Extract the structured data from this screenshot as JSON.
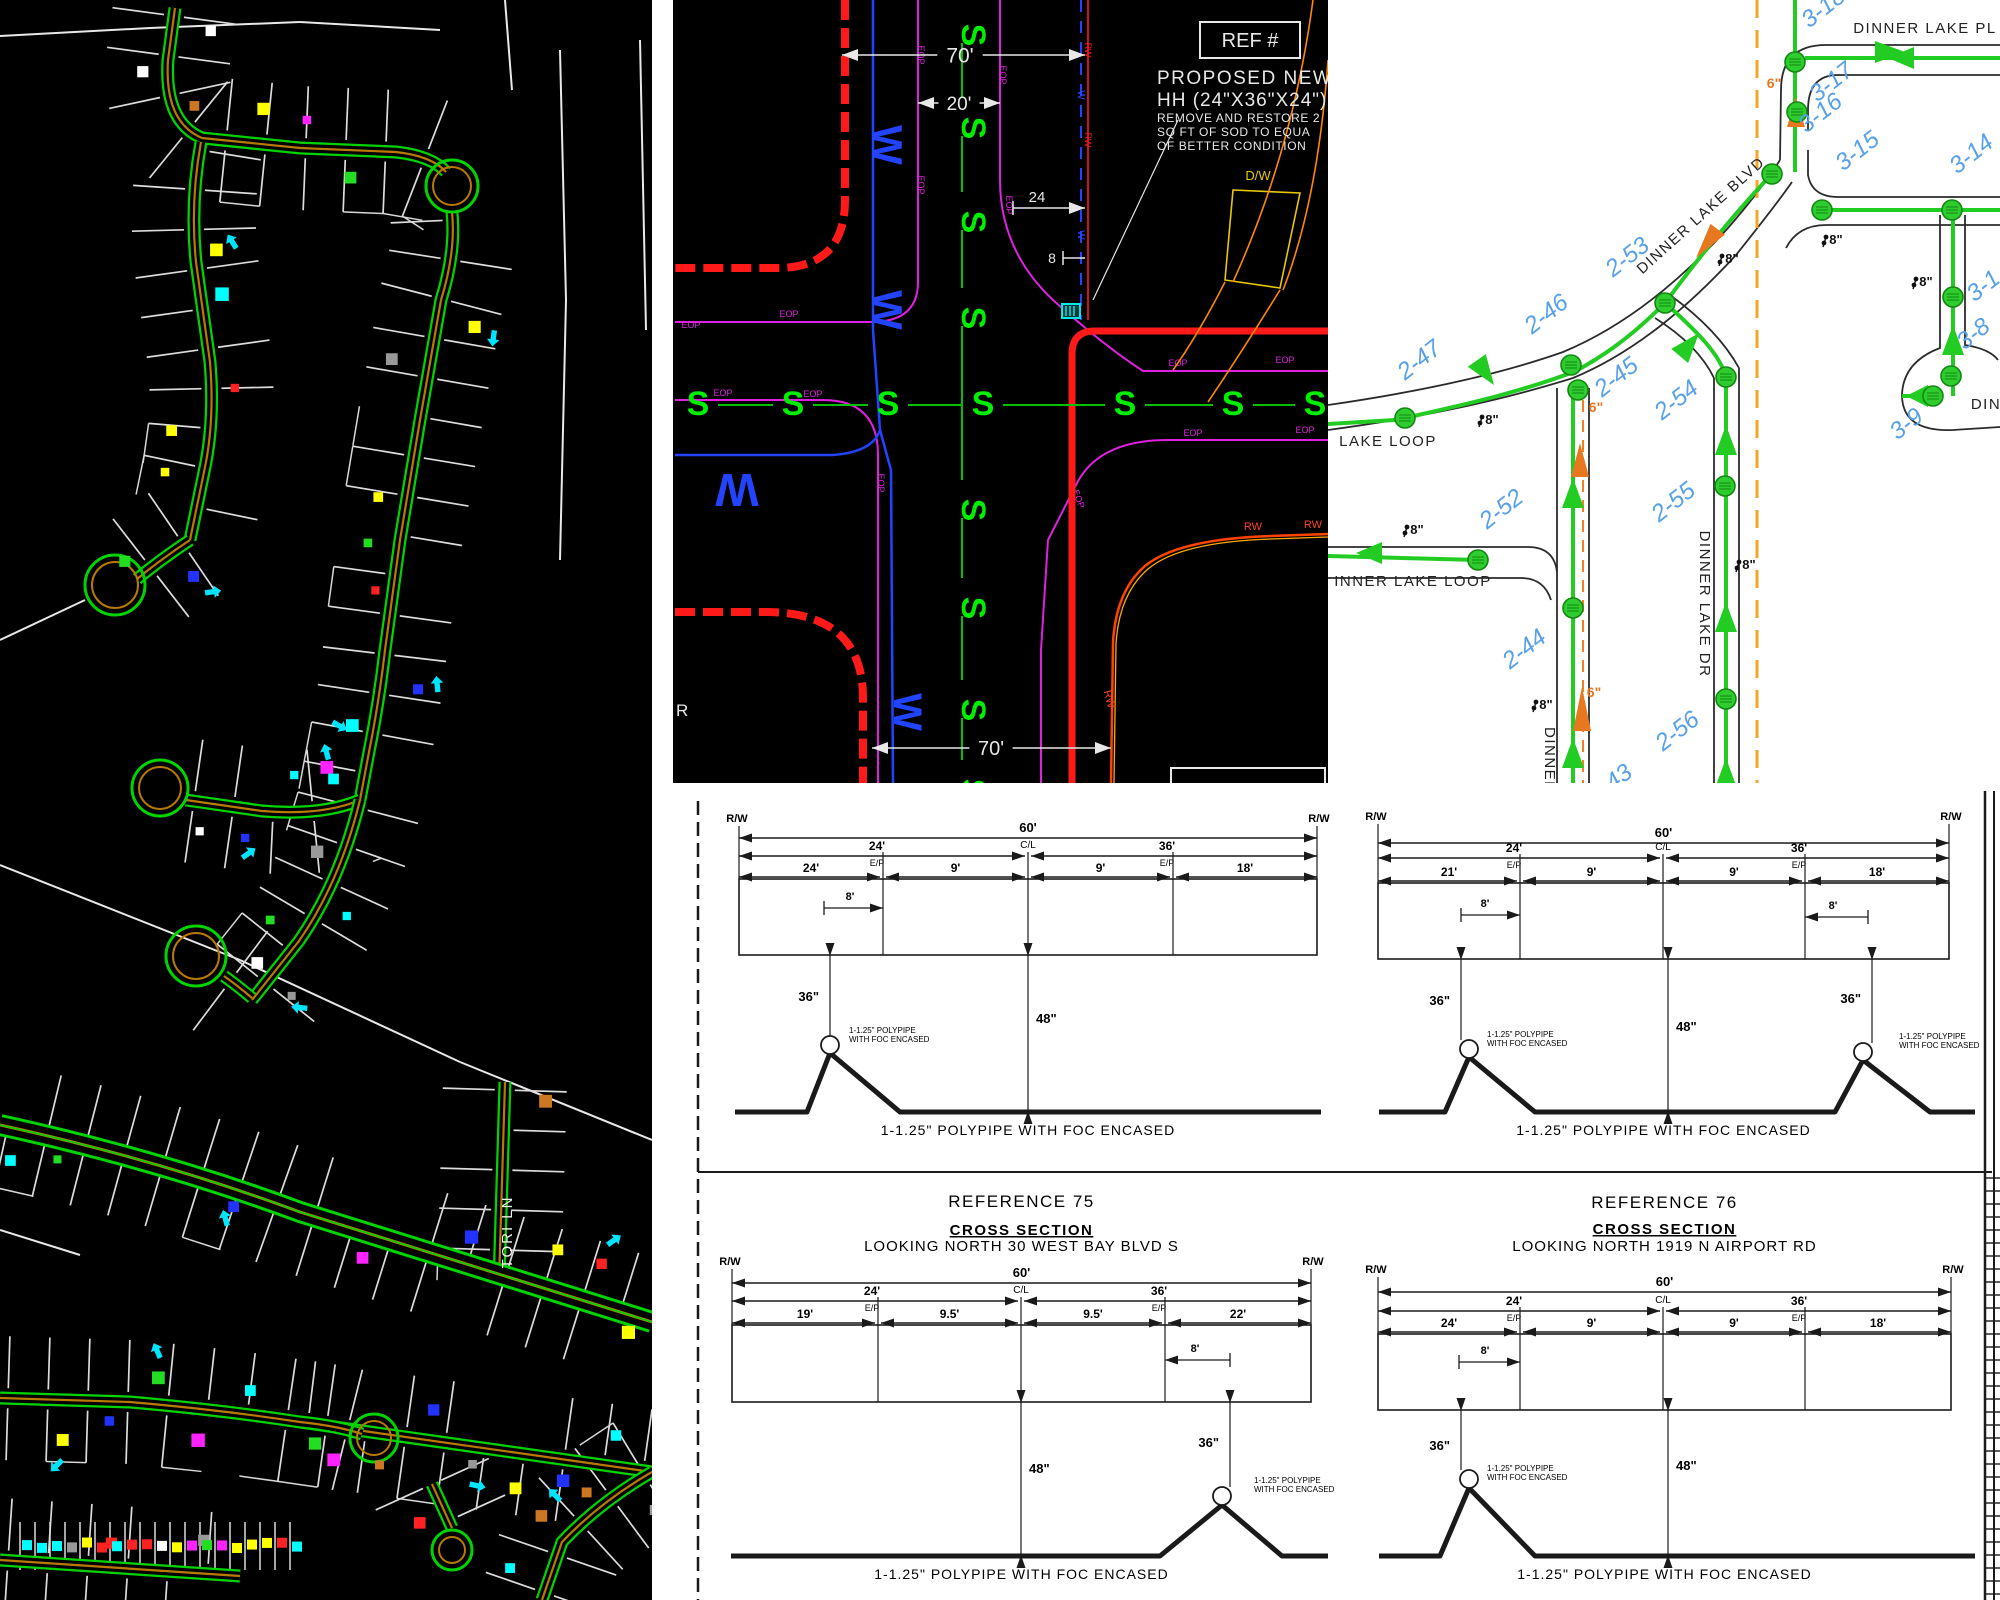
{
  "left_map": {
    "street_label": "TORI LN",
    "marker_colors": [
      "#ffff00",
      "#ff2222",
      "#ff22ff",
      "#00ffff",
      "#2233ff",
      "#22dd22",
      "#ffffff",
      "#999999",
      "#cc7722"
    ]
  },
  "intersection": {
    "ref_label": "REF #",
    "callout_lines": [
      "PROPOSED NEW F",
      "HH (24\"X36\"X24\")",
      "REMOVE AND RESTORE 2",
      "SQ FT OF SOD TO EQUA",
      "OF BETTER CONDITION"
    ],
    "dw_label": "D/W",
    "eop_label": "EOP",
    "rw_label": "RW",
    "sewer_glyph": "S",
    "water_glyph": "W",
    "street_partial": "R",
    "dims": {
      "top_width": "70'",
      "pavement": "20'",
      "offset": "24",
      "hh_offset": "8",
      "bottom_width": "70'"
    }
  },
  "route_map": {
    "streets": [
      {
        "text": "DINNER LAKE PL",
        "x": 597,
        "y": 33,
        "rot": 0
      },
      {
        "text": "DINNER LAKE BLVD",
        "x": 376,
        "y": 219,
        "rot": -42
      },
      {
        "text": "DINNER LAKE DR",
        "x": 372,
        "y": 604,
        "rot": 90
      },
      {
        "text": "LAKE LOOP",
        "x": 60,
        "y": 446,
        "rot": 0
      },
      {
        "text": "INNER LAKE LOOP",
        "x": 85,
        "y": 586,
        "rot": 0
      },
      {
        "text": "DINNER L",
        "x": 217,
        "y": 768,
        "rot": 90
      },
      {
        "text": "DIN",
        "x": 658,
        "y": 409,
        "rot": 0
      }
    ],
    "handholes": [
      {
        "text": "2-47",
        "x": 96,
        "y": 366
      },
      {
        "text": "2-46",
        "x": 223,
        "y": 320
      },
      {
        "text": "2-53",
        "x": 304,
        "y": 263
      },
      {
        "text": "2-45",
        "x": 293,
        "y": 383
      },
      {
        "text": "2-54",
        "x": 353,
        "y": 406
      },
      {
        "text": "2-52",
        "x": 178,
        "y": 515
      },
      {
        "text": "2-55",
        "x": 350,
        "y": 508
      },
      {
        "text": "2-44",
        "x": 201,
        "y": 655
      },
      {
        "text": "2-56",
        "x": 354,
        "y": 737
      },
      {
        "text": "2-43",
        "x": 287,
        "y": 790
      },
      {
        "text": "3-17",
        "x": 508,
        "y": 88
      },
      {
        "text": "3-16",
        "x": 497,
        "y": 119
      },
      {
        "text": "3-18",
        "x": 500,
        "y": 14
      },
      {
        "text": "3-15",
        "x": 534,
        "y": 157
      },
      {
        "text": "3-14",
        "x": 648,
        "y": 160
      },
      {
        "text": "3-1",
        "x": 660,
        "y": 292
      },
      {
        "text": "3-9",
        "x": 583,
        "y": 430
      },
      {
        "text": "3-8",
        "x": 650,
        "y": 340
      }
    ],
    "six_labels": [
      {
        "x": 446,
        "y": 88
      },
      {
        "x": 268,
        "y": 412
      },
      {
        "x": 266,
        "y": 697
      }
    ],
    "six_text": "6\"",
    "eight_labels": [
      {
        "x": 404,
        "y": 263
      },
      {
        "x": 598,
        "y": 286
      },
      {
        "x": 164,
        "y": 424
      },
      {
        "x": 89,
        "y": 534
      },
      {
        "x": 218,
        "y": 709
      },
      {
        "x": 421,
        "y": 569
      },
      {
        "x": 508,
        "y": 244
      }
    ],
    "eight_text": "8\""
  },
  "cross_sections": {
    "pipe_note": "1-1.25\" POLYPIPE WITH FOC ENCASED",
    "pipe_callout": [
      "1-1.25\" POLYPIPE",
      "WITH FOC ENCASED"
    ],
    "rw": "R/W",
    "cl": "C/L",
    "ep": "E/P",
    "total": "60'",
    "left_half": "24'",
    "right_half": "36'",
    "offset8": "8'",
    "depth36": "36\"",
    "depth48": "48\"",
    "sections": [
      {
        "id": "top-left",
        "widths": [
          "24'",
          "9'",
          "9'",
          "18'"
        ]
      },
      {
        "id": "top-right",
        "widths": [
          "21'",
          "9'",
          "9'",
          "18'"
        ]
      },
      {
        "id": "bottom-left",
        "reference": "REFERENCE 75",
        "subtitle": "CROSS SECTION",
        "looking": "LOOKING NORTH 30 WEST BAY BLVD S",
        "widths": [
          "19'",
          "9.5'",
          "9.5'",
          "22'"
        ]
      },
      {
        "id": "bottom-right",
        "reference": "REFERENCE 76",
        "subtitle": "CROSS SECTION",
        "looking": "LOOKING NORTH 1919 N AIRPORT RD",
        "widths": [
          "24'",
          "9'",
          "9'",
          "18'"
        ]
      }
    ]
  }
}
